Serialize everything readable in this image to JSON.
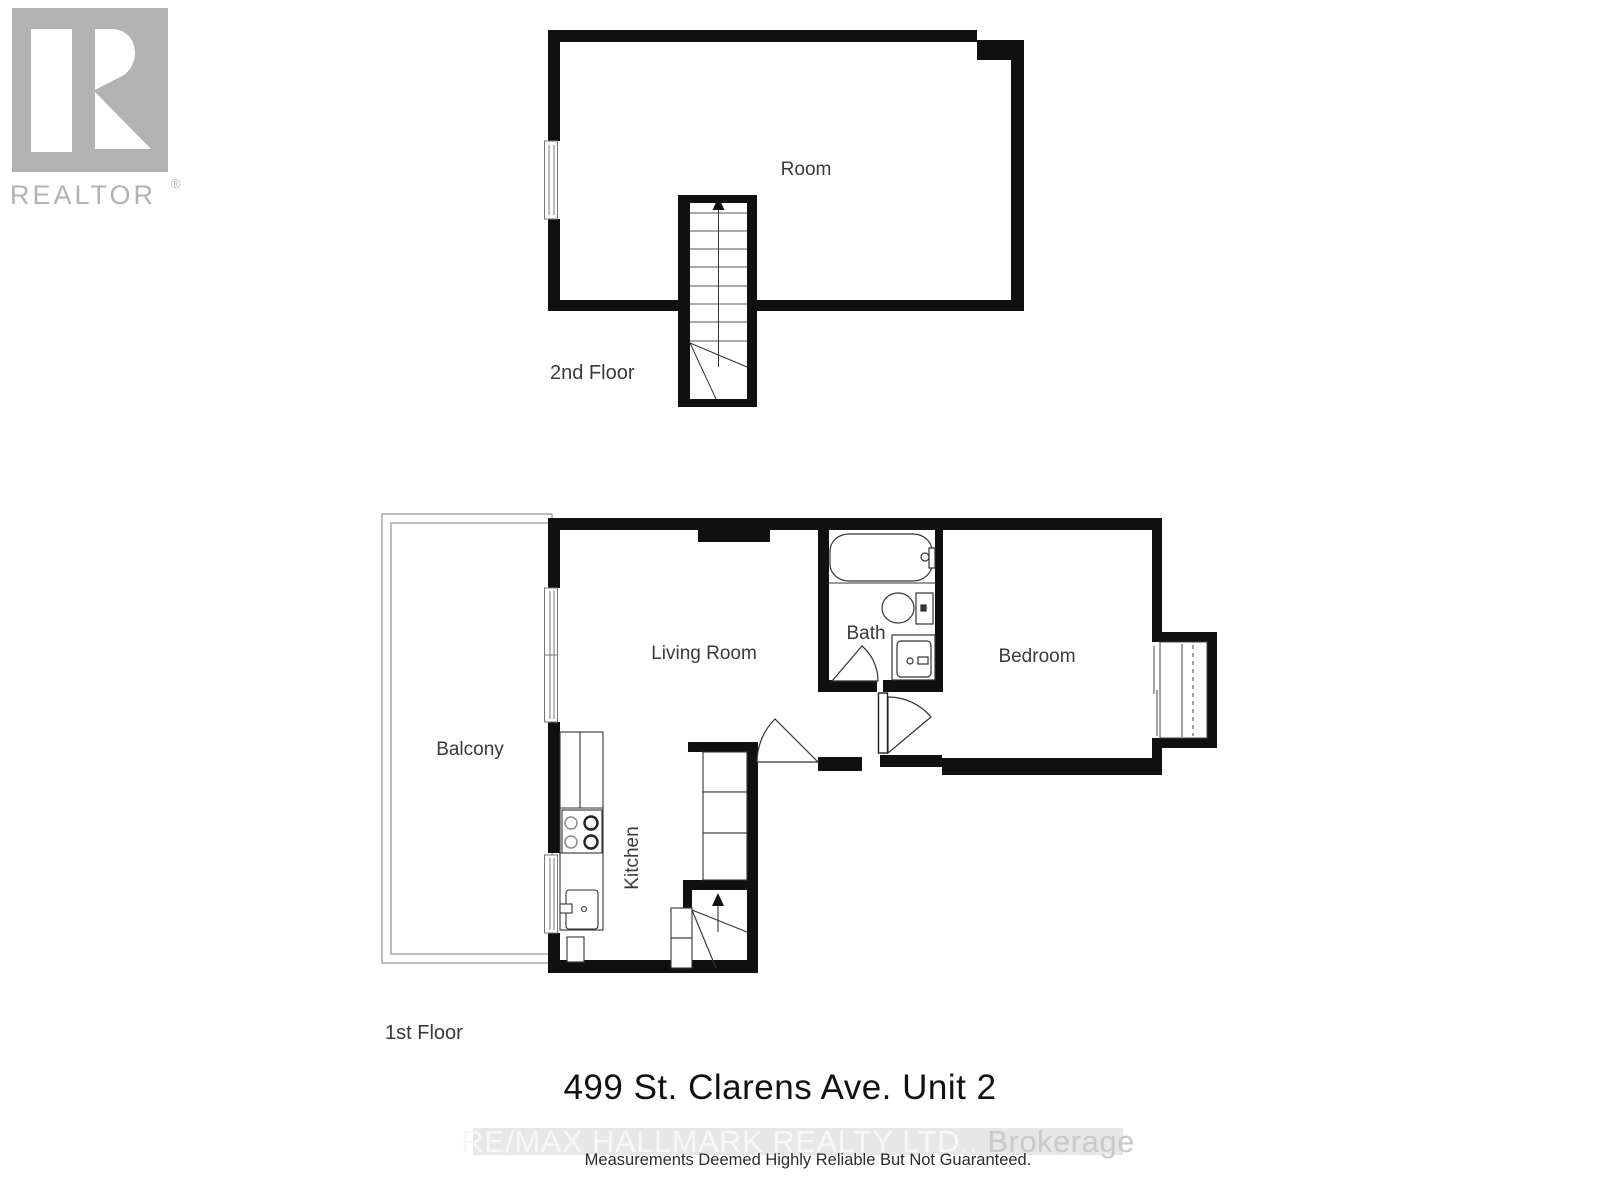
{
  "logo": {
    "realtor_text": "REALTOR",
    "registered_mark": "®"
  },
  "second_floor": {
    "room_label": "Room",
    "floor_label": "2nd Floor"
  },
  "first_floor": {
    "living_room_label": "Living Room",
    "balcony_label": "Balcony",
    "bath_label": "Bath",
    "bedroom_label": "Bedroom",
    "kitchen_label": "Kitchen",
    "floor_label": "1st Floor"
  },
  "footer": {
    "title": "499 St. Clarens Ave. Unit 2",
    "watermark_main": "RE/MAX HALLMARK REALTY LTD., ",
    "watermark_suffix": "Brokerage",
    "disclaimer": "Measurements Deemed Highly Reliable But Not Guaranteed."
  },
  "colors": {
    "wall": "#101010",
    "fixture_line": "#333333",
    "window_line": "#777777",
    "label_text": "#3a3a3a",
    "logo_gray": "#b2b2b2",
    "watermark_band": "#e7e7e7",
    "watermark_text": "#f7f7f7",
    "watermark_suffix_text": "#c9c9c9"
  }
}
